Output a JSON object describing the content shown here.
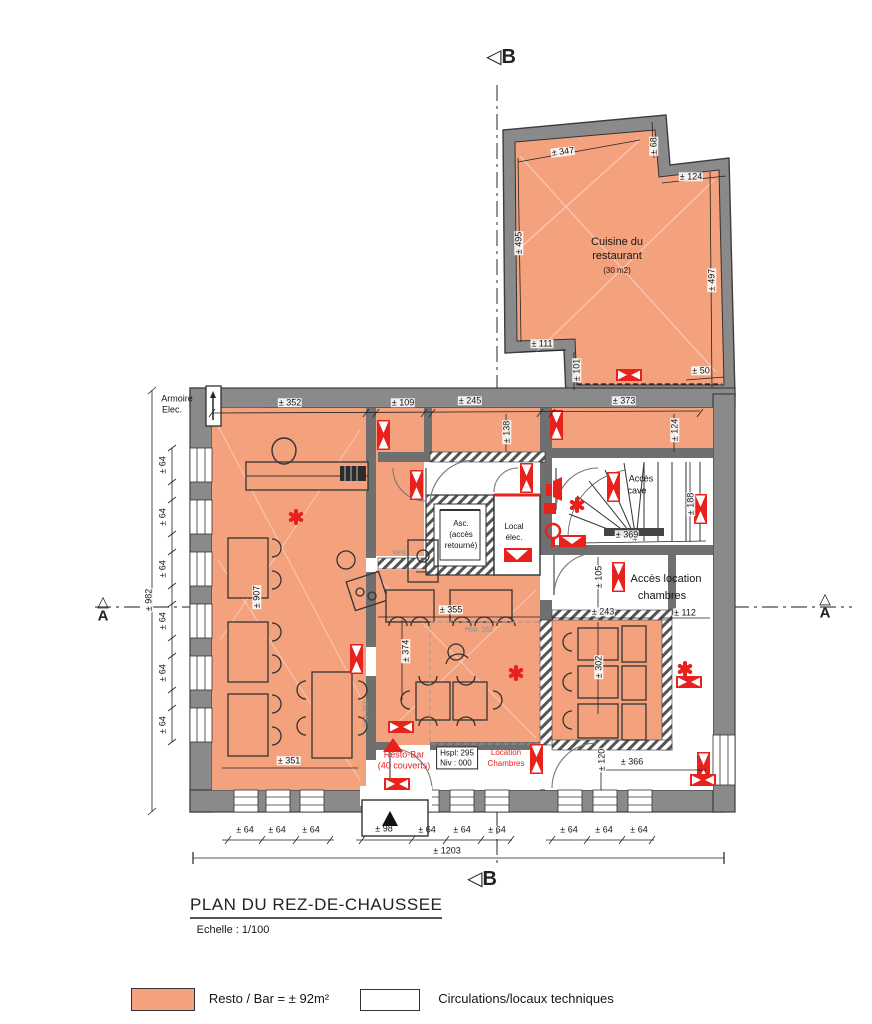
{
  "colors": {
    "resto_fill": "#F4A17E",
    "wall_gray": "#8a8a8a",
    "partition_gray": "#6f6f6f",
    "accent_red": "#e8211d",
    "circulation_white": "#ffffff"
  },
  "markers": {
    "tri_left": "◁",
    "tri_up": "△",
    "b": "B",
    "a": "A"
  },
  "rooms": {
    "cuisine_l1": "Cuisine du",
    "cuisine_l2": "restaurant",
    "cuisine_l3": "(30 m2)",
    "armoire_l1": "Armoire",
    "armoire_l2": "Elec.",
    "asc_l1": "Asc.",
    "asc_l2": "(accès",
    "asc_l3": "retourné)",
    "vest": "Vest.",
    "local_l1": "Local",
    "local_l2": "élec.",
    "cave_l1": "Accès",
    "cave_l2": "cave",
    "loc_l1": "Accès location",
    "loc_l2": "chambres",
    "resto_l1": "Resto-Bar",
    "resto_l2": "(40 couverts)",
    "hspl_l1": "Hspl: 295",
    "hspl_l2": "Niv : 000",
    "locch_l1": "Location",
    "locch_l2": "Chambres",
    "hsp_center": "Hsp: 262",
    "hsp_left": "Hsp 262"
  },
  "dims": {
    "k347": "± 347",
    "k68": "± 68",
    "k124t": "± 124",
    "k495": "± 495",
    "k497": "± 497",
    "k111": "± 111",
    "k101": "± 101",
    "k50": "± 50",
    "m352": "± 352",
    "m109": "± 109",
    "m245": "± 245",
    "m138": "± 138",
    "m373": "± 373",
    "m124r": "± 124",
    "l64": "± 64",
    "l982": "± 982",
    "l907": "± 907",
    "c355": "± 355",
    "c374": "± 374",
    "s188": "± 188",
    "s369": "± 369",
    "a105": "± 105",
    "a243": "± 243",
    "a112": "± 112",
    "b302": "± 302",
    "b120": "± 120",
    "b366": "± 366",
    "r351": "± 351",
    "b64": "± 64",
    "b98": "± 98",
    "b1203": "± 1203"
  },
  "title": {
    "text": "PLAN DU REZ-DE-CHAUSSEE",
    "scale": "Echelle : 1/100"
  },
  "legend": {
    "resto": "Resto / Bar = ± 92m²",
    "circ": "Circulations/locaux techniques"
  }
}
